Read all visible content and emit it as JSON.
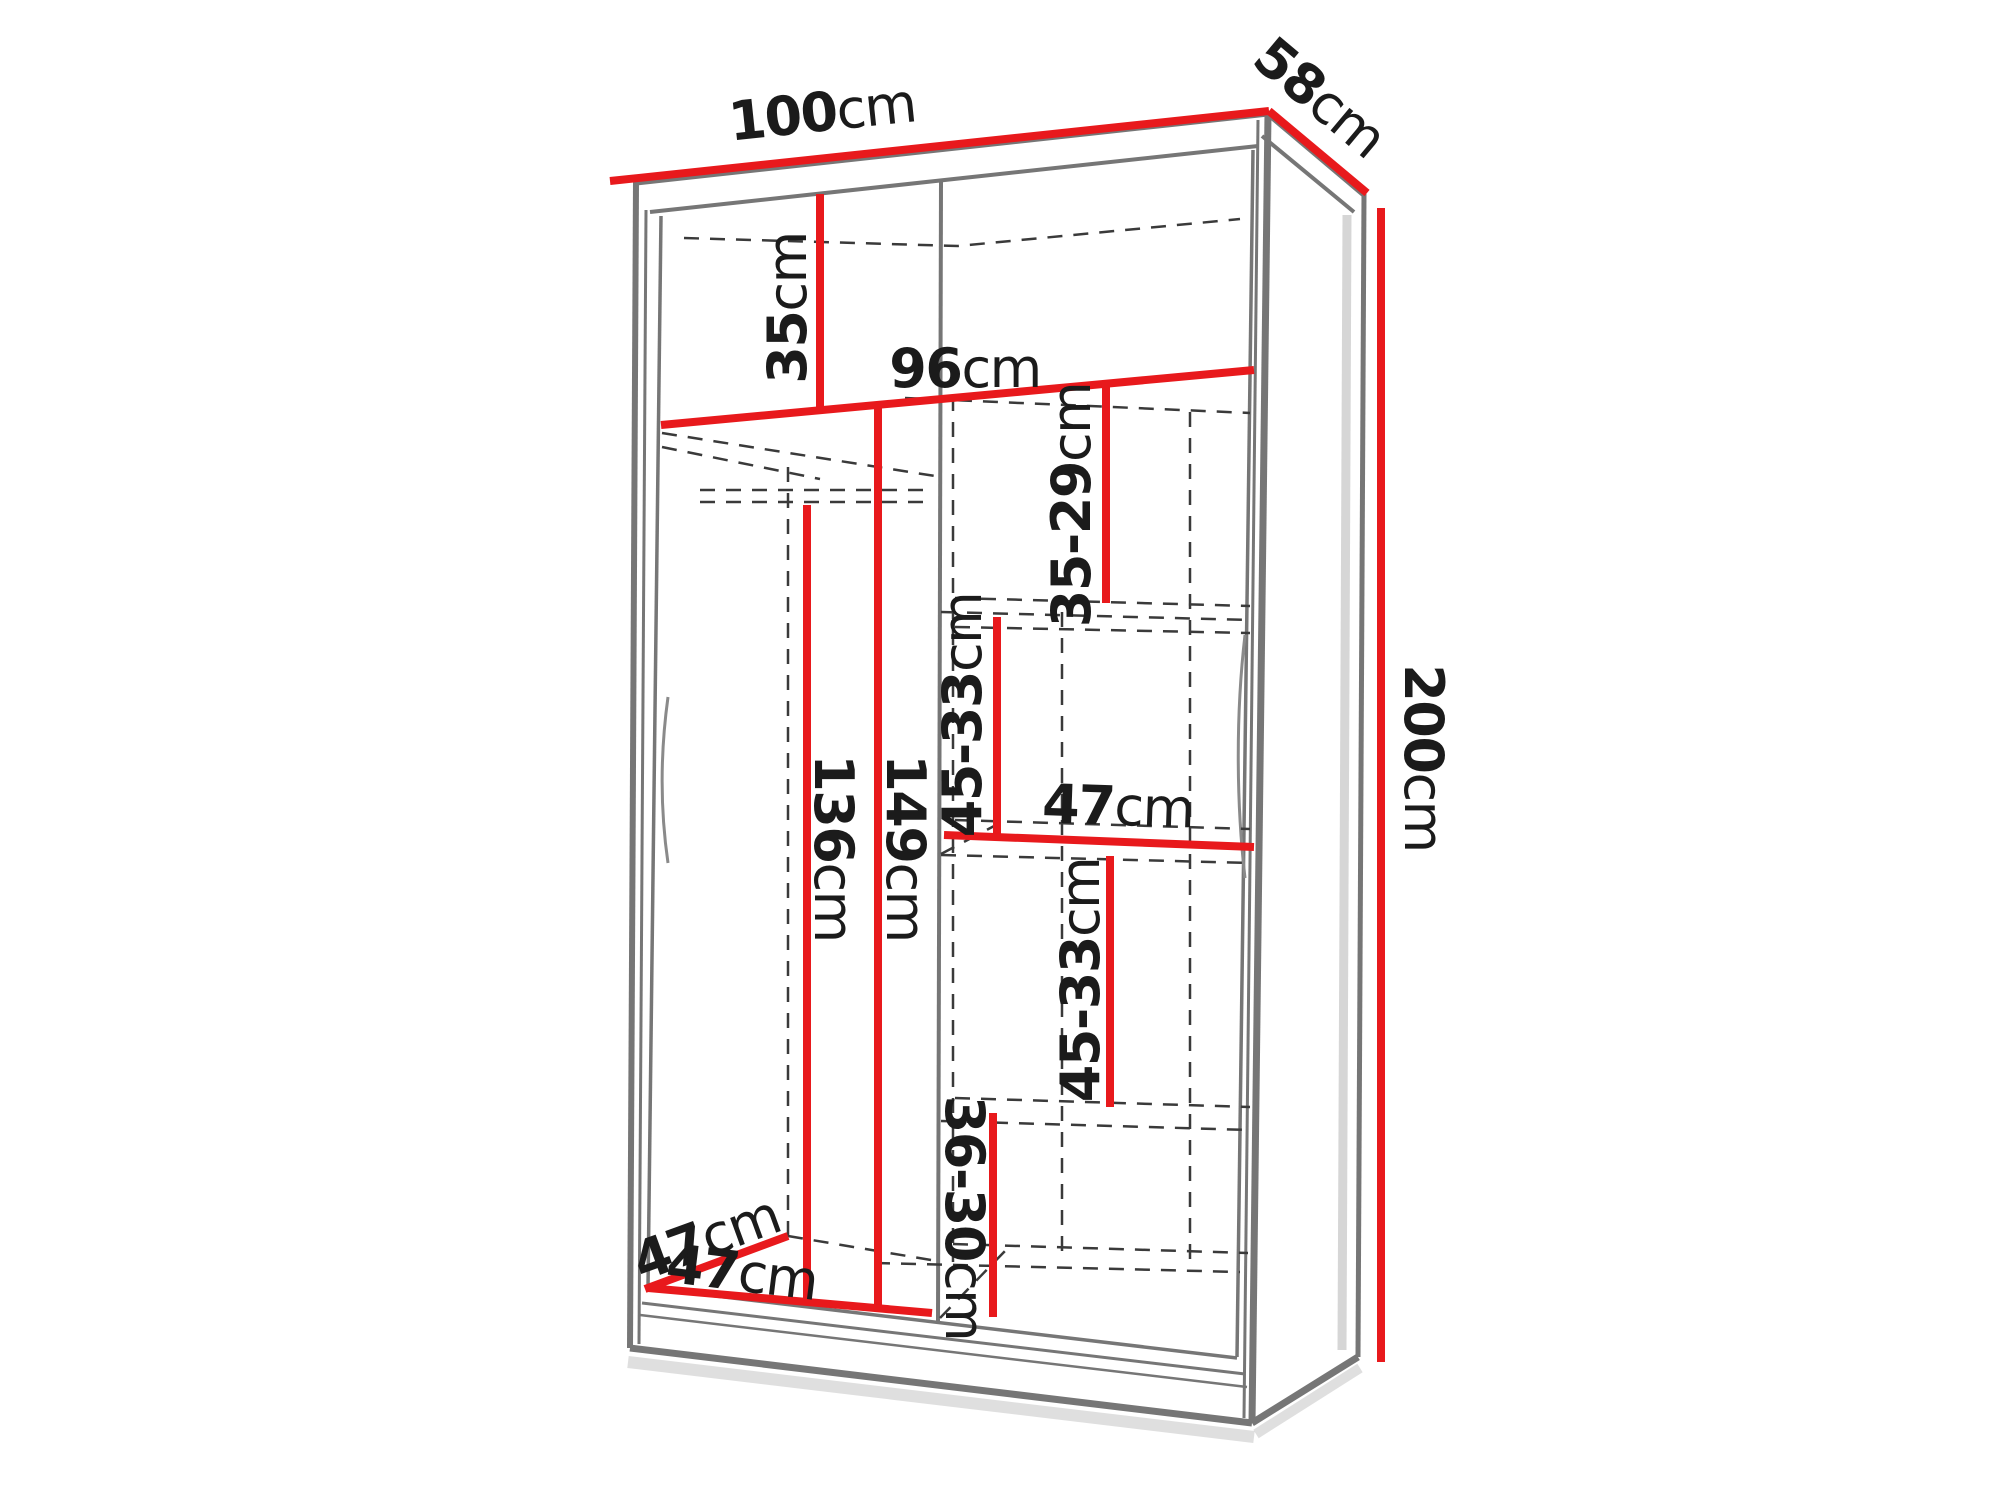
{
  "colors": {
    "dimension_red": "#e8191c",
    "cabinet_grey": "#767676",
    "dash_grey": "#3a3a3a",
    "label_text": "#1b1b1b",
    "background": "#ffffff",
    "shadow_grey": "#c4c4c4"
  },
  "dimensions": {
    "width_top": {
      "value": "100",
      "unit": "cm"
    },
    "depth_top": {
      "value": "58",
      "unit": "cm"
    },
    "height_side": {
      "value": "200",
      "unit": "cm"
    },
    "top_shelf_height": {
      "value": "35",
      "unit": "cm"
    },
    "interior_width": {
      "value": "96",
      "unit": "cm"
    },
    "right_gap_1": {
      "value": "35-29",
      "unit": "cm"
    },
    "right_gap_2": {
      "value": "45-33",
      "unit": "cm"
    },
    "middle_shelf_depth": {
      "value": "47",
      "unit": "cm"
    },
    "right_gap_3": {
      "value": "45-33",
      "unit": "cm"
    },
    "right_gap_4": {
      "value": "36-30",
      "unit": "cm"
    },
    "hanging_height_front": {
      "value": "136",
      "unit": "cm"
    },
    "hanging_height_back": {
      "value": "149",
      "unit": "cm"
    },
    "bottom_depth": {
      "value": "47",
      "unit": "cm"
    },
    "bottom_width": {
      "value": "47",
      "unit": "cm"
    }
  }
}
